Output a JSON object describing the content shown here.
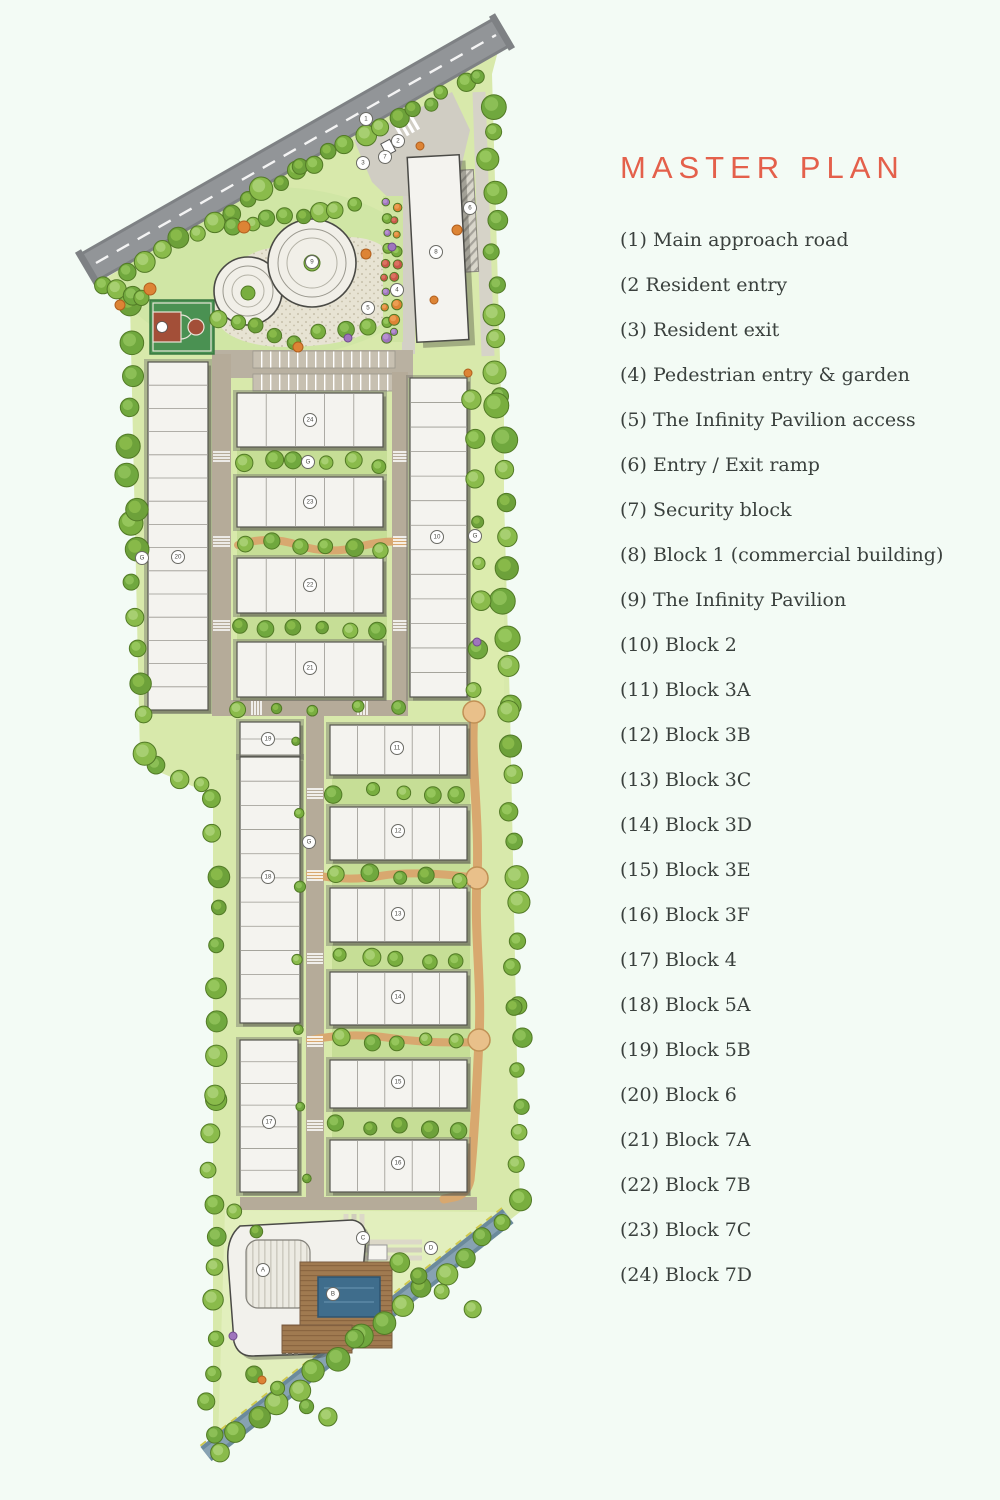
{
  "title": "MASTER PLAN",
  "colors": {
    "accent": "#e4604b",
    "legend_text": "#3a403d",
    "background": "#f3fbf5",
    "road": "#929598",
    "water_band": "#7d97a6",
    "lawn": "#d8e9ab",
    "path_orange": "#d8a86f",
    "court_green": "#4a9152",
    "court_red": "#a34f38",
    "pool_blue": "#3f6d8c"
  },
  "legend": {
    "items": [
      "(1) Main approach road",
      "(2 Resident entry",
      "(3) Resident exit",
      "(4) Pedestrian entry & garden",
      "(5) The Infinity Pavilion access",
      "(6) Entry / Exit ramp",
      "(7) Security block",
      "(8) Block 1 (commercial building)",
      "(9) The Infinity Pavilion",
      "(10) Block 2",
      "(11) Block 3A",
      "(12) Block 3B",
      "(13) Block 3C",
      "(14) Block 3D",
      "(15) Block 3E",
      "(16) Block 3F",
      "(17) Block 4",
      "(18) Block 5A",
      "(19) Block 5B",
      "(20) Block 6",
      "(21) Block 7A",
      "(22) Block 7B",
      "(23) Block 7C",
      "(24) Block 7D"
    ]
  },
  "map": {
    "badges": [
      {
        "label": "1",
        "x": 366,
        "y": 119
      },
      {
        "label": "2",
        "x": 398,
        "y": 141
      },
      {
        "label": "7",
        "x": 385,
        "y": 157
      },
      {
        "label": "3",
        "x": 363,
        "y": 163
      },
      {
        "label": "6",
        "x": 470,
        "y": 208
      },
      {
        "label": "8",
        "x": 436,
        "y": 252
      },
      {
        "label": "9",
        "x": 312,
        "y": 262
      },
      {
        "label": "4",
        "x": 397,
        "y": 290
      },
      {
        "label": "5",
        "x": 368,
        "y": 308
      },
      {
        "label": "24",
        "x": 310,
        "y": 420
      },
      {
        "label": "23",
        "x": 310,
        "y": 502
      },
      {
        "label": "22",
        "x": 310,
        "y": 585
      },
      {
        "label": "21",
        "x": 310,
        "y": 668
      },
      {
        "label": "20",
        "x": 178,
        "y": 557
      },
      {
        "label": "10",
        "x": 437,
        "y": 537
      },
      {
        "label": "G",
        "x": 475,
        "y": 536
      },
      {
        "label": "G",
        "x": 142,
        "y": 558
      },
      {
        "label": "G",
        "x": 308,
        "y": 462
      },
      {
        "label": "G",
        "x": 309,
        "y": 842
      },
      {
        "label": "19",
        "x": 268,
        "y": 739
      },
      {
        "label": "11",
        "x": 397,
        "y": 748
      },
      {
        "label": "12",
        "x": 398,
        "y": 831
      },
      {
        "label": "13",
        "x": 398,
        "y": 914
      },
      {
        "label": "14",
        "x": 398,
        "y": 997
      },
      {
        "label": "15",
        "x": 398,
        "y": 1082
      },
      {
        "label": "16",
        "x": 398,
        "y": 1163
      },
      {
        "label": "18",
        "x": 268,
        "y": 877
      },
      {
        "label": "17",
        "x": 269,
        "y": 1122
      },
      {
        "label": "C",
        "x": 363,
        "y": 1238
      },
      {
        "label": "D",
        "x": 431,
        "y": 1248
      },
      {
        "label": "A",
        "x": 263,
        "y": 1270
      },
      {
        "label": "B",
        "x": 333,
        "y": 1294
      }
    ]
  }
}
